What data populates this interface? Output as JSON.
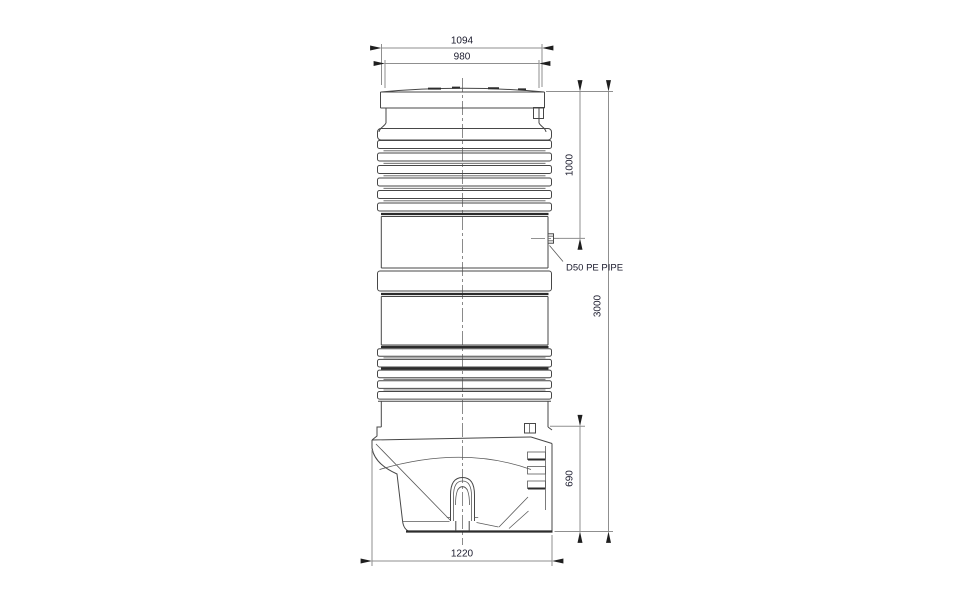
{
  "drawing": {
    "subject": "pumping-station-tank-elevation",
    "dimensions": {
      "cover_outer_width": "1094",
      "cover_inner_width": "980",
      "inlet_depth": "1000",
      "overall_height": "3000",
      "sump_height": "690",
      "sump_width": "1220"
    },
    "labels": {
      "inlet_pipe": "D50 PE PIPE"
    },
    "colors": {
      "background": "#ffffff",
      "object_line": "#474747",
      "dimension_line": "#8f8f8f",
      "arrow": "#1f1f1f",
      "text": "#1c1c2e"
    }
  }
}
